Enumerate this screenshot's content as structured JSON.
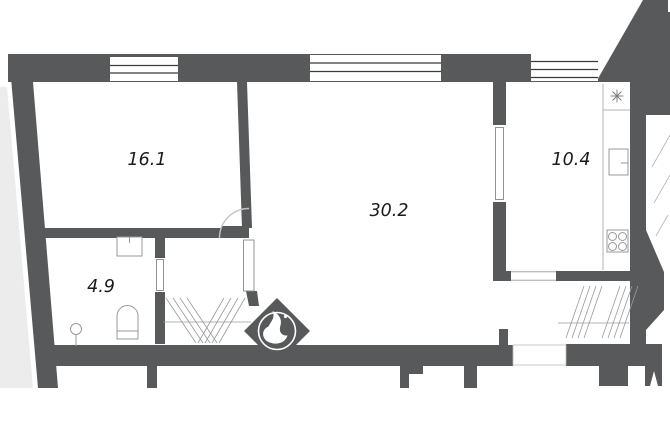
{
  "rooms": [
    {
      "name": "room-left",
      "area": "16.1"
    },
    {
      "name": "room-main",
      "area": "30.2"
    },
    {
      "name": "kitchen",
      "area": "10.4"
    },
    {
      "name": "bathroom",
      "area": "4.9"
    }
  ],
  "fixtures": {
    "stove_burners": 4,
    "icons": [
      "window",
      "door-leaf",
      "door-swing-arc",
      "fridge-star-icon",
      "stove-icon",
      "kitchen-sink-icon",
      "toilet-icon",
      "washbasin-icon",
      "hatch-area",
      "builder-logo"
    ]
  },
  "colors": {
    "wall": "#58595B",
    "outside": "#ECECEC",
    "fixture": "#999999",
    "counter": "#B3B3B3",
    "hatch": "#9A9A9A",
    "window_line": "#3A3A3A",
    "text": "#1A1A1A",
    "logo": "#FFFFFF"
  }
}
